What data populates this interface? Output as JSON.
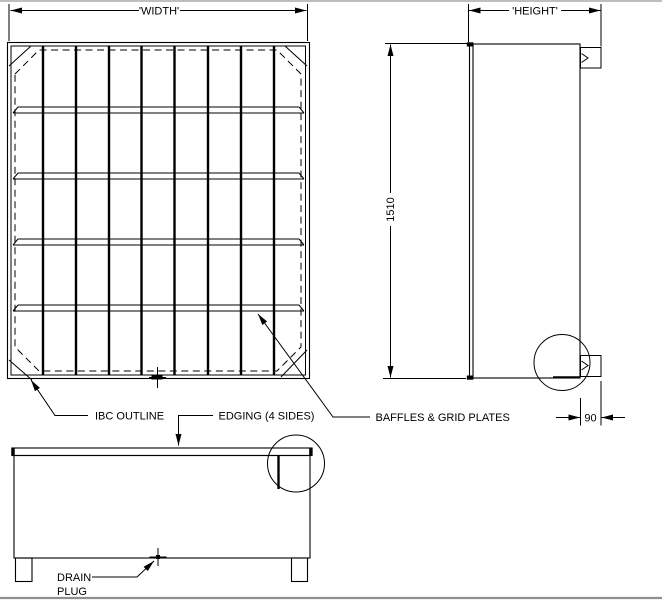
{
  "drawing": {
    "dimensions": {
      "width_label": "'WIDTH'",
      "height_label": "'HEIGHT'",
      "side_height": "1510",
      "edge_depth": "90"
    },
    "annotations": {
      "ibc_outline": "IBC OUTLINE",
      "edging": "EDGING (4 SIDES)",
      "baffles": "BAFFLES & GRID PLATES",
      "drain_line1": "DRAIN",
      "drain_line2": "PLUG"
    },
    "colors": {
      "line": "#000000",
      "background": "#ffffff",
      "frame": "#8f8f8f"
    }
  }
}
